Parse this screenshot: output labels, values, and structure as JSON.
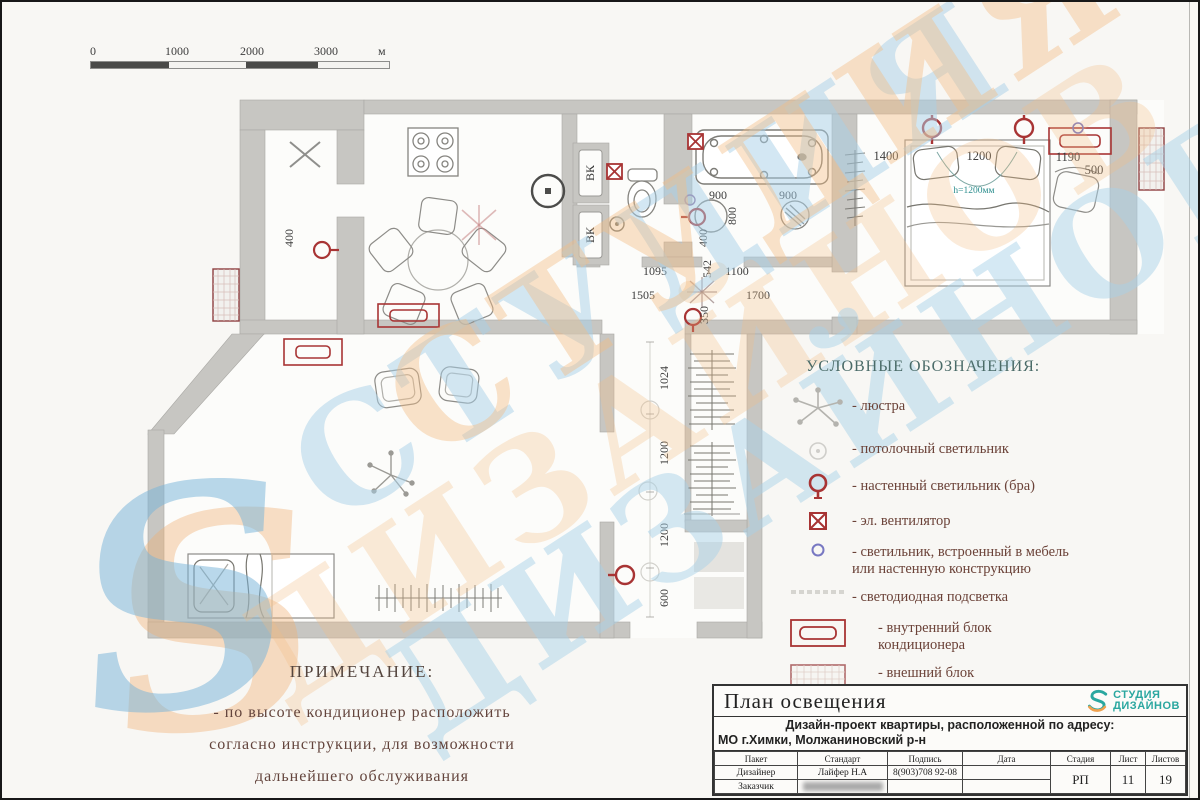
{
  "scale_bar": {
    "ticks": [
      "0",
      "1000",
      "2000",
      "3000"
    ],
    "unit": "м"
  },
  "watermark": {
    "word1": "СТУДИЯ",
    "word2": "ДИЗАЙНОВ",
    "letter": "S"
  },
  "colors": {
    "symbol_red": "#a83434",
    "legend_title_teal": "#4a6b68",
    "text_brown": "#6b4238",
    "logo_teal": "#2aa7a0",
    "logo_orange": "#f0a14e",
    "watermark_blue": "#a8d0e8",
    "watermark_orange": "#f3bd84",
    "bed_note_teal": "#2e8f8f"
  },
  "legend": {
    "title": "УСЛОВНЫЕ ОБОЗНАЧЕНИЯ:",
    "items": [
      {
        "symbol": "chandelier-icon",
        "label": "- люстра"
      },
      {
        "symbol": "ceiling-light-icon",
        "label": "- потолочный светильник"
      },
      {
        "symbol": "wall-light-icon",
        "label": "- настенный светильник (бра)"
      },
      {
        "symbol": "fan-icon",
        "label": "- эл. вентилятор"
      },
      {
        "symbol": "built-in-light-icon",
        "label": "- светильник, встроенный в мебель или настенную конструкцию"
      },
      {
        "symbol": "led-strip-icon",
        "label": "- светодиодная подсветка"
      },
      {
        "symbol": "ac-indoor-icon",
        "label": "- внутренний блок кондиционера"
      },
      {
        "symbol": "ac-outdoor-icon",
        "label": "- внешний блок кондиционера"
      }
    ]
  },
  "note": {
    "title": "ПРИМЕЧАНИЕ:",
    "line1": "- по высоте кондиционер расположить",
    "line2": "согласно инструкции,  для возможности",
    "line3": "дальнейшего обслуживания"
  },
  "title_block": {
    "drawing_title": "План освещения",
    "logo_line1": "СТУДИЯ",
    "logo_line2": "ДИЗАЙНОВ",
    "project_line1": "Дизайн-проект квартиры, расположенной по адресу:",
    "project_line2": "МО г.Химки, Молжаниновский р-н",
    "col_1": "Пакет",
    "col_2": "Стандарт",
    "col_3": "Подпись",
    "col_4": "Дата",
    "col_5": "Стадия",
    "col_6": "Лист",
    "col_7": "Листов",
    "row1_role": "Дизайнер",
    "row1_name": "Лайфер Н.А",
    "row1_sign": "8(903)708 92-08",
    "row2_role": "Заказчик",
    "stage": "РП",
    "sheet": "11",
    "sheets": "19"
  },
  "plan": {
    "shaft_label": "ВК",
    "bed_note": "h=1200мм",
    "dims": {
      "balcony": "400",
      "bath_left": "900",
      "bath_right": "900",
      "bath_800": "800",
      "bath_400": "400",
      "cor_1095": "1095",
      "cor_1505": "1505",
      "cor_542": "542",
      "cor_1100": "1100",
      "cor_1700": "1700",
      "cor_350": "350",
      "hall_1024": "1024",
      "hall_1200a": "1200",
      "hall_1200b": "1200",
      "hall_600": "600",
      "bedroom_1400": "1400",
      "bedroom_1200": "1200",
      "bedroom_1190": "1190",
      "bedroom_500": "500"
    }
  }
}
